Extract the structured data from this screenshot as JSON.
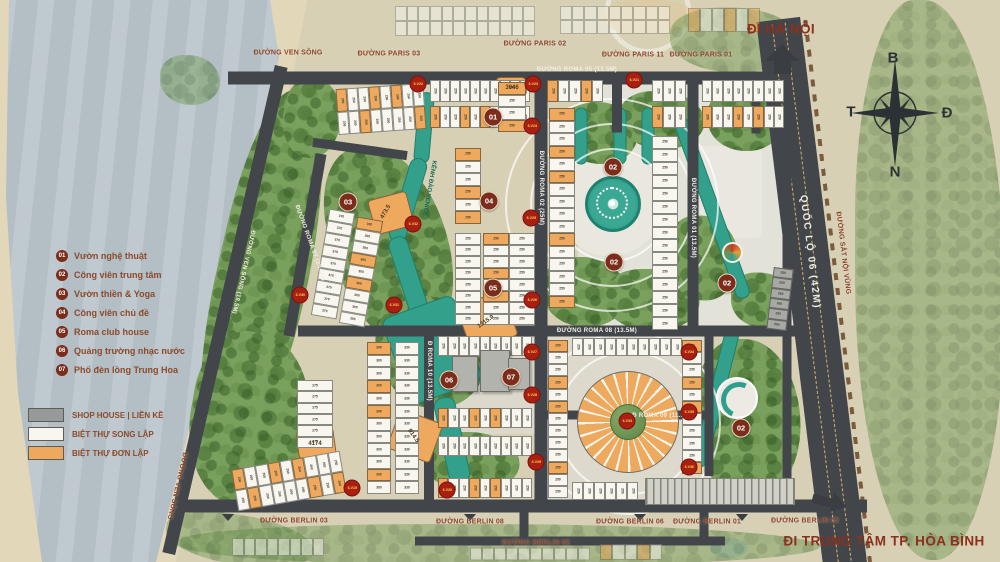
{
  "legend": {
    "poi": [
      {
        "num": "01",
        "label": "Vườn nghệ thuật"
      },
      {
        "num": "02",
        "label": "Công viên trung tâm"
      },
      {
        "num": "03",
        "label": "Vườn thiền & Yoga"
      },
      {
        "num": "04",
        "label": "Công viên chủ đề"
      },
      {
        "num": "05",
        "label": "Roma club house"
      },
      {
        "num": "06",
        "label": "Quảng trường nhạc nước"
      },
      {
        "num": "07",
        "label": "Phố đèn lồng Trung Hoa"
      }
    ],
    "types": [
      {
        "label": "SHOP HOUSE | LIỀN KỀ",
        "color": "#97999a"
      },
      {
        "label": "BIỆT THỰ SONG LẬP",
        "color": "#f8f6ef"
      },
      {
        "label": "BIỆT THỰ ĐƠN LẬP",
        "color": "#efa95e"
      }
    ]
  },
  "compass": {
    "n": "B",
    "e": "Đ",
    "s": "N",
    "w": "T"
  },
  "destinations": {
    "hanoi": "ĐI HÀ NỘI",
    "hoabinh": "ĐI TRUNG TÂM TP. HÒA BÌNH"
  },
  "colors": {
    "road": "#42464b",
    "orange_lot": "#efa95e",
    "white_lot": "#f8f6ef",
    "gray_lot": "#a8a9a4",
    "water": "#33a08b",
    "poi": "#7b2c1b",
    "badge": "#a91f12",
    "label_brown": "#8a4328"
  },
  "map": {
    "road_labels": [
      {
        "t": "ĐƯỜNG VEN SÔNG",
        "x": 288,
        "y": 53,
        "r": 0,
        "s": "B"
      },
      {
        "t": "ĐƯỜNG PARIS 03",
        "x": 389,
        "y": 54,
        "r": 0,
        "s": "B"
      },
      {
        "t": "ĐƯỜNG PARIS 02",
        "x": 535,
        "y": 44,
        "r": 0,
        "s": "B"
      },
      {
        "t": "ĐƯỜNG PARIS 11",
        "x": 633,
        "y": 55,
        "r": 0,
        "s": "B"
      },
      {
        "t": "ĐƯỜNG PARIS 01",
        "x": 701,
        "y": 55,
        "r": 0,
        "s": "B"
      },
      {
        "t": "ĐƯỜNG BERLIN 03",
        "x": 294,
        "y": 521,
        "r": 0,
        "s": "B"
      },
      {
        "t": "ĐƯỜNG BERLIN 08",
        "x": 470,
        "y": 522,
        "r": 0,
        "s": "B"
      },
      {
        "t": "ĐƯỜNG BERLIN 02",
        "x": 536,
        "y": 543,
        "r": 0,
        "s": "B"
      },
      {
        "t": "ĐƯỜNG BERLIN 06",
        "x": 630,
        "y": 522,
        "r": 0,
        "s": "B"
      },
      {
        "t": "ĐƯỜNG BERLIN 01",
        "x": 707,
        "y": 522,
        "r": 0,
        "s": "B"
      },
      {
        "t": "ĐƯỜNG BERLIN 05",
        "x": 805,
        "y": 521,
        "r": 0,
        "s": "B"
      },
      {
        "t": "ĐƯỜNG SẮT NỘI VÙNG",
        "x": 843,
        "y": 253,
        "r": 83,
        "s": "B"
      },
      {
        "t": "ĐƯỜNG VEN SÔNG",
        "x": 177,
        "y": 486,
        "r": 103,
        "s": "B"
      },
      {
        "t": "KÊNH ĐÀO VENICE",
        "x": 429,
        "y": 188,
        "r": 100,
        "s": "T"
      },
      {
        "t": "ĐƯỜNG VEN SÔNG (18.5M)",
        "x": 243,
        "y": 272,
        "r": 103,
        "s": "W"
      },
      {
        "t": "QUỐC LỘ 06 (42M)",
        "x": 810,
        "y": 252,
        "r": 83,
        "s": "W2"
      },
      {
        "t": "ĐƯỜNG ROMA 02 (25M)",
        "x": 541,
        "y": 188,
        "r": 90,
        "s": "W"
      },
      {
        "t": "ĐƯỜNG ROMA 01 (13.5M)",
        "x": 693,
        "y": 218,
        "r": 90,
        "s": "W"
      },
      {
        "t": "ĐƯỜNG ROMA 08 (13.5M)",
        "x": 597,
        "y": 331,
        "r": 0,
        "s": "W"
      },
      {
        "t": "Đ ROMA 09 (11.5M)",
        "x": 662,
        "y": 416,
        "r": 0,
        "s": "W"
      },
      {
        "t": "ĐƯỜNG ROMA 07 (20.5M)",
        "x": 310,
        "y": 243,
        "r": 70,
        "s": "W"
      },
      {
        "t": "Đ ROMA 10 (13.5M)",
        "x": 429,
        "y": 371,
        "r": 90,
        "s": "W"
      },
      {
        "t": "ĐƯỜNG ROMA 05 (13.5M)",
        "x": 577,
        "y": 70,
        "r": 0,
        "s": "W"
      }
    ],
    "pois": [
      {
        "n": "01",
        "x": 493,
        "y": 117
      },
      {
        "n": "02",
        "x": 613,
        "y": 167
      },
      {
        "n": "02",
        "x": 614,
        "y": 262
      },
      {
        "n": "02",
        "x": 727,
        "y": 283
      },
      {
        "n": "02",
        "x": 741,
        "y": 428
      },
      {
        "n": "03",
        "x": 348,
        "y": 202
      },
      {
        "n": "04",
        "x": 489,
        "y": 201
      },
      {
        "n": "05",
        "x": 493,
        "y": 288
      },
      {
        "n": "06",
        "x": 449,
        "y": 380
      },
      {
        "n": "07",
        "x": 511,
        "y": 377
      }
    ],
    "badges": [
      {
        "t": "6.V22",
        "x": 418,
        "y": 84
      },
      {
        "t": "6.V23",
        "x": 533,
        "y": 84
      },
      {
        "t": "6.V21",
        "x": 634,
        "y": 80
      },
      {
        "t": "6.V24",
        "x": 532,
        "y": 126
      },
      {
        "t": "6.V25",
        "x": 531,
        "y": 218
      },
      {
        "t": "6.V26",
        "x": 532,
        "y": 300
      },
      {
        "t": "6.V27",
        "x": 532,
        "y": 352
      },
      {
        "t": "6.V28",
        "x": 532,
        "y": 395
      },
      {
        "t": "6.V29",
        "x": 536,
        "y": 462
      },
      {
        "t": "6.V30",
        "x": 300,
        "y": 295
      },
      {
        "t": "6.V31",
        "x": 394,
        "y": 305
      },
      {
        "t": "6.V32",
        "x": 413,
        "y": 224
      },
      {
        "t": "6.V33",
        "x": 627,
        "y": 421
      },
      {
        "t": "6.V34",
        "x": 689,
        "y": 352
      },
      {
        "t": "6.V35",
        "x": 689,
        "y": 412
      },
      {
        "t": "6.V36",
        "x": 689,
        "y": 467
      },
      {
        "t": "6.V19",
        "x": 352,
        "y": 488
      },
      {
        "t": "6.V20",
        "x": 447,
        "y": 490
      }
    ],
    "big_lot_labels": [
      {
        "t": "473.5",
        "x": 386,
        "y": 212,
        "r": -60
      },
      {
        "t": "1215.9",
        "x": 486,
        "y": 322,
        "r": -35
      },
      {
        "t": "914.5",
        "x": 413,
        "y": 436,
        "r": 55
      },
      {
        "t": "4174",
        "x": 315,
        "y": 444,
        "r": 0
      },
      {
        "t": "3046",
        "x": 512,
        "y": 88,
        "r": 0
      }
    ],
    "patches": [
      {
        "x": 372,
        "y": 196,
        "w": 38,
        "h": 34,
        "r": -15
      },
      {
        "x": 463,
        "y": 298,
        "w": 48,
        "h": 46,
        "r": -20
      },
      {
        "x": 393,
        "y": 416,
        "w": 44,
        "h": 40,
        "r": 20
      },
      {
        "x": 298,
        "y": 430,
        "w": 36,
        "h": 26,
        "r": -8
      },
      {
        "x": 497,
        "y": 78,
        "w": 28,
        "h": 18,
        "r": 0
      }
    ],
    "blocks": [
      {
        "x": 337,
        "y": 86,
        "w": 88,
        "h": 46,
        "nx": 8,
        "ny": 2,
        "pal": "m",
        "lab": "250",
        "r": -4
      },
      {
        "x": 430,
        "y": 80,
        "w": 100,
        "h": 22,
        "nx": 10,
        "ny": 1,
        "pal": "w",
        "lab": "250",
        "r": 0
      },
      {
        "x": 430,
        "y": 106,
        "w": 100,
        "h": 22,
        "nx": 10,
        "ny": 1,
        "pal": "m",
        "lab": "250",
        "r": 0
      },
      {
        "x": 547,
        "y": 80,
        "w": 56,
        "h": 22,
        "nx": 5,
        "ny": 1,
        "pal": "m",
        "lab": "250",
        "r": 0
      },
      {
        "x": 652,
        "y": 80,
        "w": 34,
        "h": 22,
        "nx": 3,
        "ny": 1,
        "pal": "w",
        "lab": "250",
        "r": 0
      },
      {
        "x": 702,
        "y": 80,
        "w": 82,
        "h": 22,
        "nx": 8,
        "ny": 1,
        "pal": "w",
        "lab": "250",
        "r": 0
      },
      {
        "x": 652,
        "y": 106,
        "w": 34,
        "h": 22,
        "nx": 3,
        "ny": 1,
        "pal": "m",
        "lab": "250",
        "r": 0
      },
      {
        "x": 702,
        "y": 106,
        "w": 82,
        "h": 22,
        "nx": 8,
        "ny": 1,
        "pal": "m",
        "lab": "250",
        "r": 0
      },
      {
        "x": 320,
        "y": 210,
        "w": 26,
        "h": 108,
        "nx": 1,
        "ny": 9,
        "pal": "w",
        "lab": "370",
        "r": 10
      },
      {
        "x": 348,
        "y": 218,
        "w": 26,
        "h": 108,
        "nx": 1,
        "ny": 9,
        "pal": "m",
        "lab": "300",
        "r": 10
      },
      {
        "x": 455,
        "y": 148,
        "w": 26,
        "h": 76,
        "nx": 1,
        "ny": 6,
        "pal": "m",
        "lab": "250",
        "r": 0
      },
      {
        "x": 455,
        "y": 233,
        "w": 26,
        "h": 92,
        "nx": 1,
        "ny": 8,
        "pal": "w",
        "lab": "250",
        "r": 0
      },
      {
        "x": 483,
        "y": 233,
        "w": 26,
        "h": 92,
        "nx": 1,
        "ny": 8,
        "pal": "m",
        "lab": "250",
        "r": 0
      },
      {
        "x": 509,
        "y": 233,
        "w": 26,
        "h": 92,
        "nx": 1,
        "ny": 8,
        "pal": "w",
        "lab": "250",
        "r": 0
      },
      {
        "x": 498,
        "y": 82,
        "w": 28,
        "h": 50,
        "nx": 1,
        "ny": 4,
        "pal": "m",
        "lab": "250",
        "r": 0
      },
      {
        "x": 549,
        "y": 108,
        "w": 26,
        "h": 200,
        "nx": 1,
        "ny": 16,
        "pal": "m",
        "lab": "250",
        "r": 0
      },
      {
        "x": 652,
        "y": 136,
        "w": 26,
        "h": 194,
        "nx": 1,
        "ny": 15,
        "pal": "w",
        "lab": "250",
        "r": 0
      },
      {
        "x": 297,
        "y": 380,
        "w": 36,
        "h": 68,
        "nx": 1,
        "ny": 6,
        "pal": "w",
        "lab": "275",
        "r": 0
      },
      {
        "x": 234,
        "y": 460,
        "w": 110,
        "h": 42,
        "nx": 9,
        "ny": 2,
        "pal": "m",
        "lab": "250",
        "r": -10
      },
      {
        "x": 367,
        "y": 342,
        "w": 24,
        "h": 152,
        "nx": 1,
        "ny": 12,
        "pal": "m",
        "lab": "300",
        "r": 0
      },
      {
        "x": 395,
        "y": 342,
        "w": 24,
        "h": 152,
        "nx": 1,
        "ny": 12,
        "pal": "w",
        "lab": "330",
        "r": 0
      },
      {
        "x": 438,
        "y": 336,
        "w": 94,
        "h": 20,
        "nx": 9,
        "ny": 1,
        "pal": "w",
        "lab": "250",
        "r": 0
      },
      {
        "x": 438,
        "y": 408,
        "w": 94,
        "h": 20,
        "nx": 9,
        "ny": 1,
        "pal": "m",
        "lab": "250",
        "r": 0
      },
      {
        "x": 438,
        "y": 436,
        "w": 94,
        "h": 20,
        "nx": 9,
        "ny": 1,
        "pal": "w",
        "lab": "250",
        "r": 0
      },
      {
        "x": 438,
        "y": 478,
        "w": 94,
        "h": 20,
        "nx": 9,
        "ny": 1,
        "pal": "m",
        "lab": "250",
        "r": 0
      },
      {
        "x": 548,
        "y": 340,
        "w": 20,
        "h": 158,
        "nx": 1,
        "ny": 13,
        "pal": "m",
        "lab": "250",
        "r": 0
      },
      {
        "x": 682,
        "y": 340,
        "w": 20,
        "h": 134,
        "nx": 1,
        "ny": 11,
        "pal": "m",
        "lab": "250",
        "r": 0
      },
      {
        "x": 572,
        "y": 338,
        "w": 110,
        "h": 18,
        "nx": 10,
        "ny": 1,
        "pal": "w",
        "lab": "250",
        "r": 0
      },
      {
        "x": 572,
        "y": 482,
        "w": 66,
        "h": 18,
        "nx": 6,
        "ny": 1,
        "pal": "w",
        "lab": "250",
        "r": 0
      },
      {
        "x": 770,
        "y": 268,
        "w": 20,
        "h": 62,
        "nx": 1,
        "ny": 6,
        "pal": "g",
        "lab": "250",
        "r": 7
      },
      {
        "x": 395,
        "y": 6,
        "w": 140,
        "h": 30,
        "nx": 12,
        "ny": 2,
        "pal": "w",
        "lab": "",
        "r": 0,
        "fade": 1
      },
      {
        "x": 560,
        "y": 6,
        "w": 110,
        "h": 28,
        "nx": 9,
        "ny": 2,
        "pal": "w",
        "lab": "",
        "r": 0,
        "fade": 1
      },
      {
        "x": 688,
        "y": 8,
        "w": 72,
        "h": 24,
        "nx": 6,
        "ny": 1,
        "pal": "m",
        "lab": "",
        "r": 0,
        "fade": 1
      },
      {
        "x": 232,
        "y": 538,
        "w": 92,
        "h": 18,
        "nx": 8,
        "ny": 1,
        "pal": "w",
        "lab": "",
        "r": 0,
        "fade": 1
      },
      {
        "x": 470,
        "y": 547,
        "w": 120,
        "h": 13,
        "nx": 10,
        "ny": 1,
        "pal": "w",
        "lab": "",
        "r": 0,
        "fade": 1
      },
      {
        "x": 600,
        "y": 544,
        "w": 62,
        "h": 16,
        "nx": 5,
        "ny": 1,
        "pal": "m",
        "lab": "",
        "r": 0,
        "fade": 1
      }
    ],
    "greens": [
      {
        "cx": 262,
        "cy": 278,
        "w": 92,
        "h": 380,
        "r": 13
      },
      {
        "cx": 312,
        "cy": 118,
        "w": 58,
        "h": 80,
        "r": 10
      },
      {
        "cx": 390,
        "cy": 245,
        "w": 115,
        "h": 205,
        "r": -15
      },
      {
        "cx": 432,
        "cy": 352,
        "w": 105,
        "h": 115,
        "r": -20
      },
      {
        "cx": 250,
        "cy": 420,
        "w": 120,
        "h": 175,
        "r": 10
      },
      {
        "cx": 472,
        "cy": 462,
        "w": 95,
        "h": 60,
        "r": 0
      },
      {
        "cx": 600,
        "cy": 133,
        "w": 75,
        "h": 62,
        "r": 0
      },
      {
        "cx": 662,
        "cy": 120,
        "w": 85,
        "h": 58,
        "r": 0
      },
      {
        "cx": 585,
        "cy": 292,
        "w": 85,
        "h": 70,
        "r": 0
      },
      {
        "cx": 652,
        "cy": 300,
        "w": 95,
        "h": 62,
        "r": 0
      },
      {
        "cx": 703,
        "cy": 258,
        "w": 72,
        "h": 85,
        "r": 0
      },
      {
        "cx": 745,
        "cy": 120,
        "w": 75,
        "h": 62,
        "r": 0
      },
      {
        "cx": 762,
        "cy": 300,
        "w": 62,
        "h": 55,
        "r": 0
      },
      {
        "cx": 748,
        "cy": 420,
        "w": 105,
        "h": 162,
        "r": 0
      },
      {
        "cx": 930,
        "cy": 280,
        "w": 150,
        "h": 560,
        "r": 0,
        "fade": 1
      },
      {
        "cx": 500,
        "cy": 545,
        "w": 640,
        "h": 42,
        "r": 0,
        "fade": 1
      },
      {
        "cx": 240,
        "cy": 540,
        "w": 150,
        "h": 50,
        "r": 8,
        "fade": 1
      },
      {
        "cx": 735,
        "cy": 40,
        "w": 130,
        "h": 65,
        "r": 0,
        "fade": 1
      },
      {
        "cx": 190,
        "cy": 80,
        "w": 60,
        "h": 50,
        "r": 0,
        "fade": 1
      }
    ],
    "canals": [
      {
        "cx": 424,
        "cy": 128,
        "w": 14,
        "h": 70,
        "r": 5
      },
      {
        "cx": 408,
        "cy": 200,
        "w": 16,
        "h": 85,
        "r": 17
      },
      {
        "cx": 408,
        "cy": 275,
        "w": 18,
        "h": 78,
        "r": -18
      },
      {
        "cx": 432,
        "cy": 350,
        "w": 75,
        "h": 90,
        "r": -20
      },
      {
        "cx": 452,
        "cy": 440,
        "w": 20,
        "h": 85,
        "r": -12
      },
      {
        "cx": 712,
        "cy": 208,
        "w": 13,
        "h": 190,
        "r": -20
      },
      {
        "cx": 716,
        "cy": 398,
        "w": 13,
        "h": 140,
        "r": 14
      },
      {
        "cx": 581,
        "cy": 136,
        "w": 11,
        "h": 55,
        "r": 0
      },
      {
        "cx": 620,
        "cy": 136,
        "w": 11,
        "h": 55,
        "r": 0
      },
      {
        "cx": 648,
        "cy": 136,
        "w": 11,
        "h": 55,
        "r": 0
      }
    ],
    "roads": [
      {
        "cx": 517,
        "cy": 78,
        "w": 578,
        "h": 13,
        "r": 0
      },
      {
        "cx": 526,
        "cy": 506,
        "w": 682,
        "h": 13,
        "r": 0
      },
      {
        "cx": 570,
        "cy": 541,
        "w": 310,
        "h": 9,
        "r": 0
      },
      {
        "cx": 524,
        "cy": 526,
        "w": 9,
        "h": 28,
        "r": 0
      },
      {
        "cx": 704,
        "cy": 526,
        "w": 9,
        "h": 28,
        "r": 0
      },
      {
        "cx": 225,
        "cy": 310,
        "w": 13,
        "h": 500,
        "r": 13
      },
      {
        "cx": 812,
        "cy": 295,
        "w": 44,
        "h": 555,
        "r": -7,
        "lanes": 1
      },
      {
        "cx": 541,
        "cy": 292,
        "w": 13,
        "h": 428,
        "r": 0
      },
      {
        "cx": 693,
        "cy": 207,
        "w": 11,
        "h": 258,
        "r": 0
      },
      {
        "cx": 617,
        "cy": 105,
        "w": 10,
        "h": 55,
        "r": 0
      },
      {
        "cx": 547,
        "cy": 331,
        "w": 498,
        "h": 11,
        "r": 0
      },
      {
        "cx": 305,
        "cy": 245,
        "w": 11,
        "h": 185,
        "r": 10
      },
      {
        "cx": 429,
        "cy": 419,
        "w": 10,
        "h": 174,
        "r": 0
      },
      {
        "cx": 628,
        "cy": 415,
        "w": 170,
        "h": 9,
        "r": 0
      },
      {
        "cx": 709,
        "cy": 406,
        "w": 9,
        "h": 140,
        "r": 0
      },
      {
        "cx": 756,
        "cy": 106,
        "w": 9,
        "h": 55,
        "r": 0
      },
      {
        "cx": 787,
        "cy": 292,
        "w": 9,
        "h": 428,
        "r": 0
      },
      {
        "cx": 360,
        "cy": 149,
        "w": 95,
        "h": 9,
        "r": 8
      }
    ]
  }
}
